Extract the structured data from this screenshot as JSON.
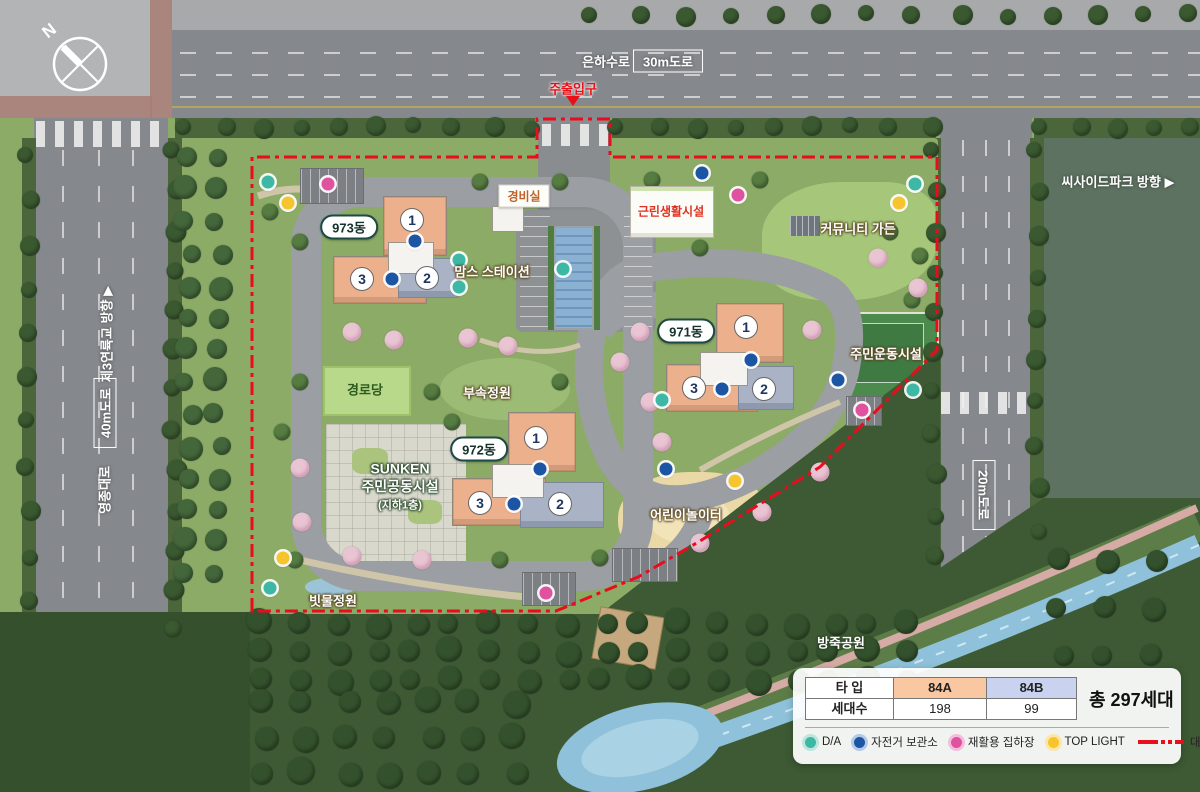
{
  "map": {
    "compass_n": "N",
    "roads": {
      "top_name": "은하수로",
      "top_size": "30m도로",
      "main_entrance": "주출입구",
      "left_dir": "제3연륙교 방향 ▶",
      "left_size": "40m도로",
      "left_name": "영종대로",
      "right_dir": "씨사이드파크 방향 ▶",
      "right_size": "20m도로"
    },
    "facilities": {
      "guard_post": "경비실",
      "neighborhood": "근린생활시설",
      "community_garden": "커뮤니티 가든",
      "moms_station": "맘스 스테이션",
      "sports": "주민운동시설",
      "senior_center": "경로당",
      "annex_garden": "부속정원",
      "sunken_line1": "SUNKEN",
      "sunken_line2": "주민공동시설",
      "sunken_line3": "(지하1층)",
      "playground": "어린이놀이터",
      "rain_garden": "빗물정원",
      "bangjuk_park": "방죽공원"
    },
    "buildings": [
      {
        "name": "973동",
        "units": [
          "1",
          "2",
          "3"
        ]
      },
      {
        "name": "971동",
        "units": [
          "1",
          "2",
          "3"
        ]
      },
      {
        "name": "972동",
        "units": [
          "1",
          "2",
          "3"
        ]
      }
    ],
    "markers": {
      "da": [
        [
          268,
          182
        ],
        [
          459,
          260
        ],
        [
          459,
          287
        ],
        [
          563,
          269
        ],
        [
          915,
          184
        ],
        [
          662,
          400
        ],
        [
          913,
          390
        ],
        [
          270,
          588
        ]
      ],
      "bike": [
        [
          415,
          241
        ],
        [
          392,
          279
        ],
        [
          702,
          173
        ],
        [
          751,
          360
        ],
        [
          722,
          389
        ],
        [
          838,
          380
        ],
        [
          540,
          469
        ],
        [
          514,
          504
        ],
        [
          666,
          469
        ]
      ],
      "recycle": [
        [
          328,
          184
        ],
        [
          738,
          195
        ],
        [
          862,
          410
        ],
        [
          546,
          593
        ]
      ],
      "toplight": [
        [
          288,
          203
        ],
        [
          899,
          203
        ],
        [
          735,
          481
        ],
        [
          283,
          558
        ]
      ]
    }
  },
  "legend": {
    "table": {
      "type_label": "타 입",
      "count_label": "세대수",
      "types": [
        {
          "name": "84A",
          "count": "198",
          "color": "#f9c8a2"
        },
        {
          "name": "84B",
          "count": "99",
          "color": "#c9d3ef"
        }
      ],
      "total": "총 297세대"
    },
    "items": [
      {
        "label": "D/A",
        "color": "#3db8a5",
        "ring": "#bce5dd"
      },
      {
        "label": "자전거 보관소",
        "color": "#1c55a4",
        "ring": "#b3c9e6"
      },
      {
        "label": "재활용 집하장",
        "color": "#e052a0",
        "ring": "#f3bedb"
      },
      {
        "label": "TOP LIGHT",
        "color": "#f6c52e",
        "ring": "#fbe6a8"
      }
    ],
    "boundary": {
      "label": "대지경계선",
      "color": "#e8101c"
    }
  },
  "colors": {
    "unit_84a": "#ecb08d",
    "unit_84b": "#a9b3c5",
    "site_green": "#8cab66",
    "water": "#8fc2da",
    "boundary_line": "#e8101c"
  }
}
